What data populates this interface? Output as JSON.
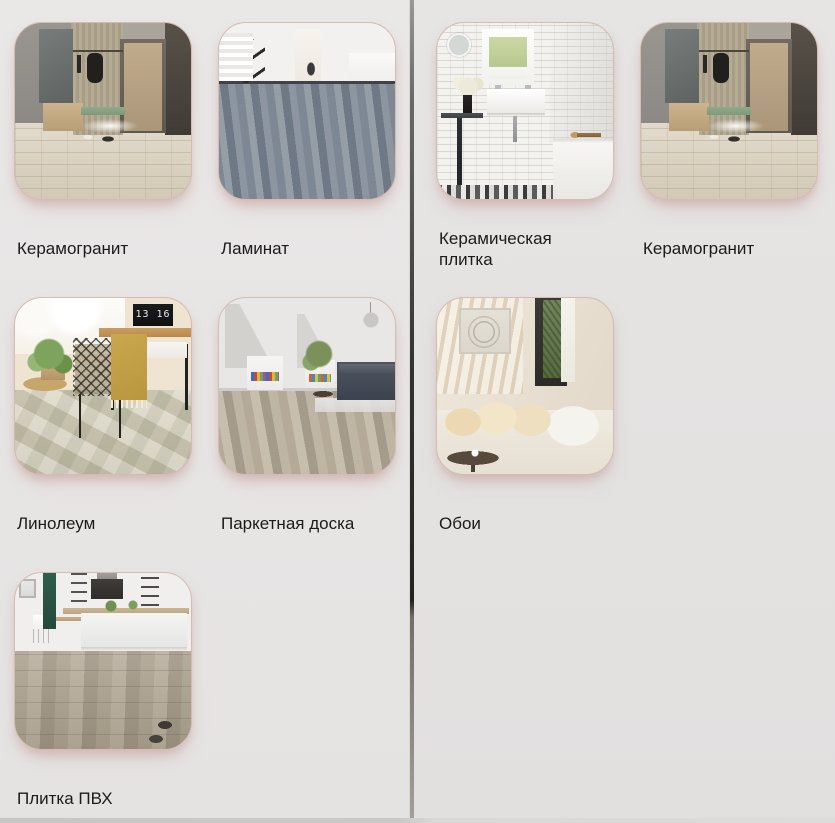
{
  "window": {
    "width": 835,
    "height": 823
  },
  "colors": {
    "panel_left_bg": "#e9e7e6",
    "panel_right_bg": "#e5e4e3",
    "divider": "#33332f",
    "label_text": "#1b1b1b",
    "card_border": "#d3bcb2",
    "card_shadow": "rgba(198,160,156,0.5)"
  },
  "panels": [
    {
      "side": "left",
      "items": [
        {
          "label": "Керамогранит",
          "image": "hallway"
        },
        {
          "label": "Ламинат",
          "image": "laminate"
        },
        {
          "label": "Линолеум",
          "image": "linoleum",
          "clock": "13 16"
        },
        {
          "label": "Паркетная доска",
          "image": "parquet"
        },
        {
          "label": "Плитка ПВХ",
          "image": "pvc"
        }
      ]
    },
    {
      "side": "right",
      "items": [
        {
          "label": "Керамическая плитка",
          "image": "bathroom"
        },
        {
          "label": "Керамогранит",
          "image": "hallway"
        },
        {
          "label": "Обои",
          "image": "wallpaper"
        }
      ]
    }
  ],
  "images": {
    "hallway": "entryway with coat rack, bench, beige door and whitewashed ceramic-granite floor",
    "laminate": "white classic hall with staircase and grey laminate plank floor",
    "linoleum": "workspace with wire chair, mustard throw, wooden desk, digital clock and checkered linoleum floor",
    "parquet": "attic living room with dark sofa, book niches and parquet board floor",
    "pvc": "kitchen with white island, green accent wall and greige PVC plank floor",
    "bathroom": "white subway-tile bathroom with round mirror, sink, flowers and bathtub",
    "wallpaper": "living room corner with cream sofa, pillows, round table and window"
  }
}
